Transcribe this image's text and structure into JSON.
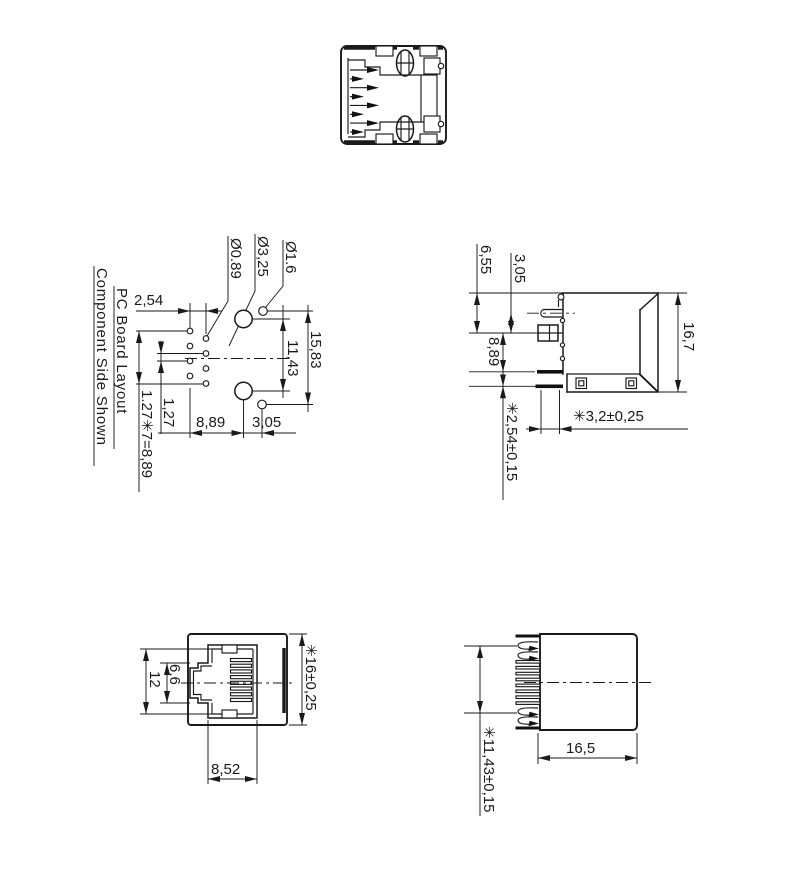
{
  "notes": {
    "line1": "PC Board Layout",
    "line2": "Component Side Shown"
  },
  "pcb": {
    "pitch": "2,54",
    "hole_pin": "Ø0.89",
    "hole_mount": "Ø3,25",
    "hole_post": "Ø1.6",
    "span_posts": "15,83",
    "span_mounts": "11,43",
    "row_pitch": "1,27",
    "row_total": "1.27✳7=8,89",
    "dist_a": "8,89",
    "dist_b": "3,05"
  },
  "side": {
    "a": "6,55",
    "b": "3,05",
    "c": "8,89",
    "height": "16,7",
    "pin_len": "✳3,2±0,25",
    "pin_pitch": "✳2,54±0,15"
  },
  "front": {
    "h_open": "12",
    "h_latch": "6,6",
    "width": "✳16±0,25",
    "w_open": "8,52"
  },
  "rear": {
    "depth": "16,5",
    "height": "✳11,43±0,15"
  },
  "colors": {
    "line": "#1a1a1a",
    "background": "#ffffff"
  }
}
